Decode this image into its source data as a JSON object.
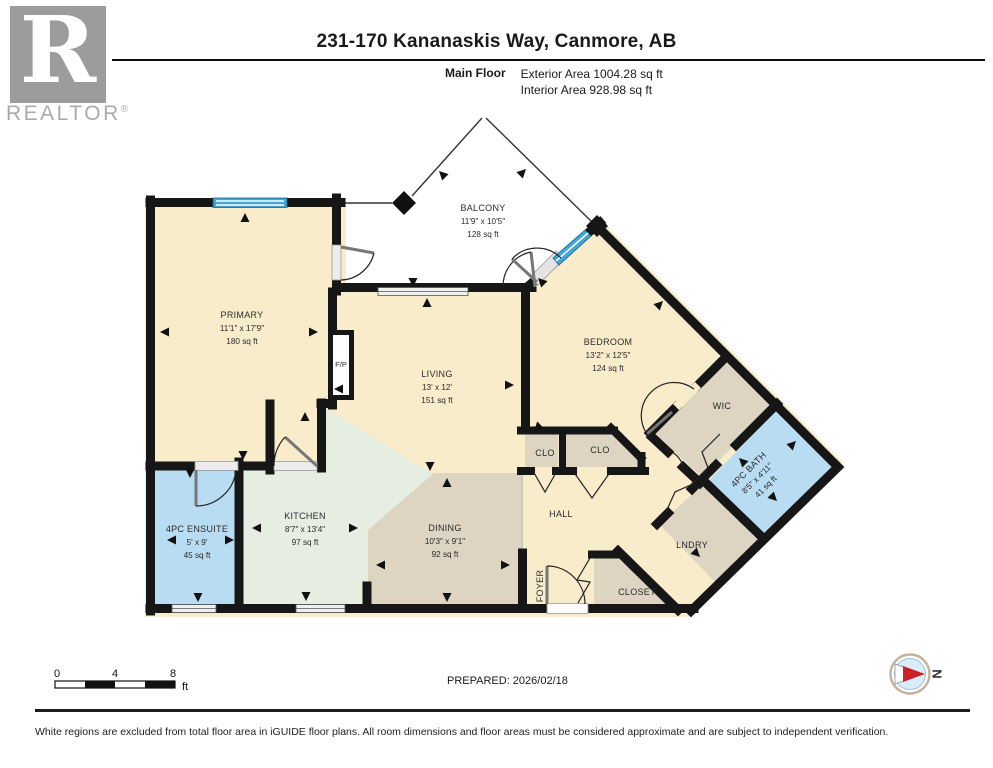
{
  "header": {
    "title": "231-170 Kananaskis Way, Canmore, AB",
    "floor_label": "Main Floor",
    "exterior_area": "Exterior Area 1004.28 sq ft",
    "interior_area": "Interior Area 928.98 sq ft"
  },
  "logo": {
    "letter": "R",
    "brand": "REALTOR",
    "registered": "®"
  },
  "plan": {
    "rooms": {
      "primary": {
        "name": "PRIMARY",
        "dims": "11'1\" x 17'9\"",
        "area": "180 sq ft"
      },
      "balcony": {
        "name": "BALCONY",
        "dims": "11'9\" x 10'5\"",
        "area": "128 sq ft"
      },
      "living": {
        "name": "LIVING",
        "dims": "13' x 12'",
        "area": "151 sq ft"
      },
      "bedroom": {
        "name": "BEDROOM",
        "dims": "13'2\" x 12'5\"",
        "area": "124 sq ft"
      },
      "kitchen": {
        "name": "KITCHEN",
        "dims": "8'7\" x 13'4\"",
        "area": "97 sq ft"
      },
      "dining": {
        "name": "DINING",
        "dims": "10'3\" x 9'1\"",
        "area": "92 sq ft"
      },
      "ensuite": {
        "name": "4PC ENSUITE",
        "dims": "5' x 9'",
        "area": "45 sq ft"
      },
      "bath": {
        "name": "4PC BATH",
        "dims": "8'5\" x 4'11\"",
        "area": "41 sq ft"
      },
      "hall": {
        "name": "HALL"
      },
      "foyer": {
        "name": "FOYER"
      },
      "wic": {
        "name": "WIC"
      },
      "lndry": {
        "name": "LNDRY"
      },
      "closet": {
        "name": "CLOSET"
      },
      "clo1": {
        "name": "CLO"
      },
      "clo2": {
        "name": "CLO"
      },
      "fireplace": {
        "name": "F/P"
      }
    },
    "colors": {
      "room_cream": "#f8eccb",
      "room_green": "#e6eee2",
      "room_tan": "#ddd4c2",
      "room_blue": "#b8dcf2",
      "window_blue": "#3fa5da",
      "wall": "#161616"
    }
  },
  "footer": {
    "scale": {
      "t0": "0",
      "t1": "4",
      "t2": "8",
      "unit": "ft"
    },
    "prepared": "PREPARED: 2026/02/18",
    "north_label": "N",
    "disclaimer": "White regions are excluded from total floor area in iGUIDE floor plans. All room dimensions and floor areas must be considered approximate and are subject to independent verification."
  }
}
